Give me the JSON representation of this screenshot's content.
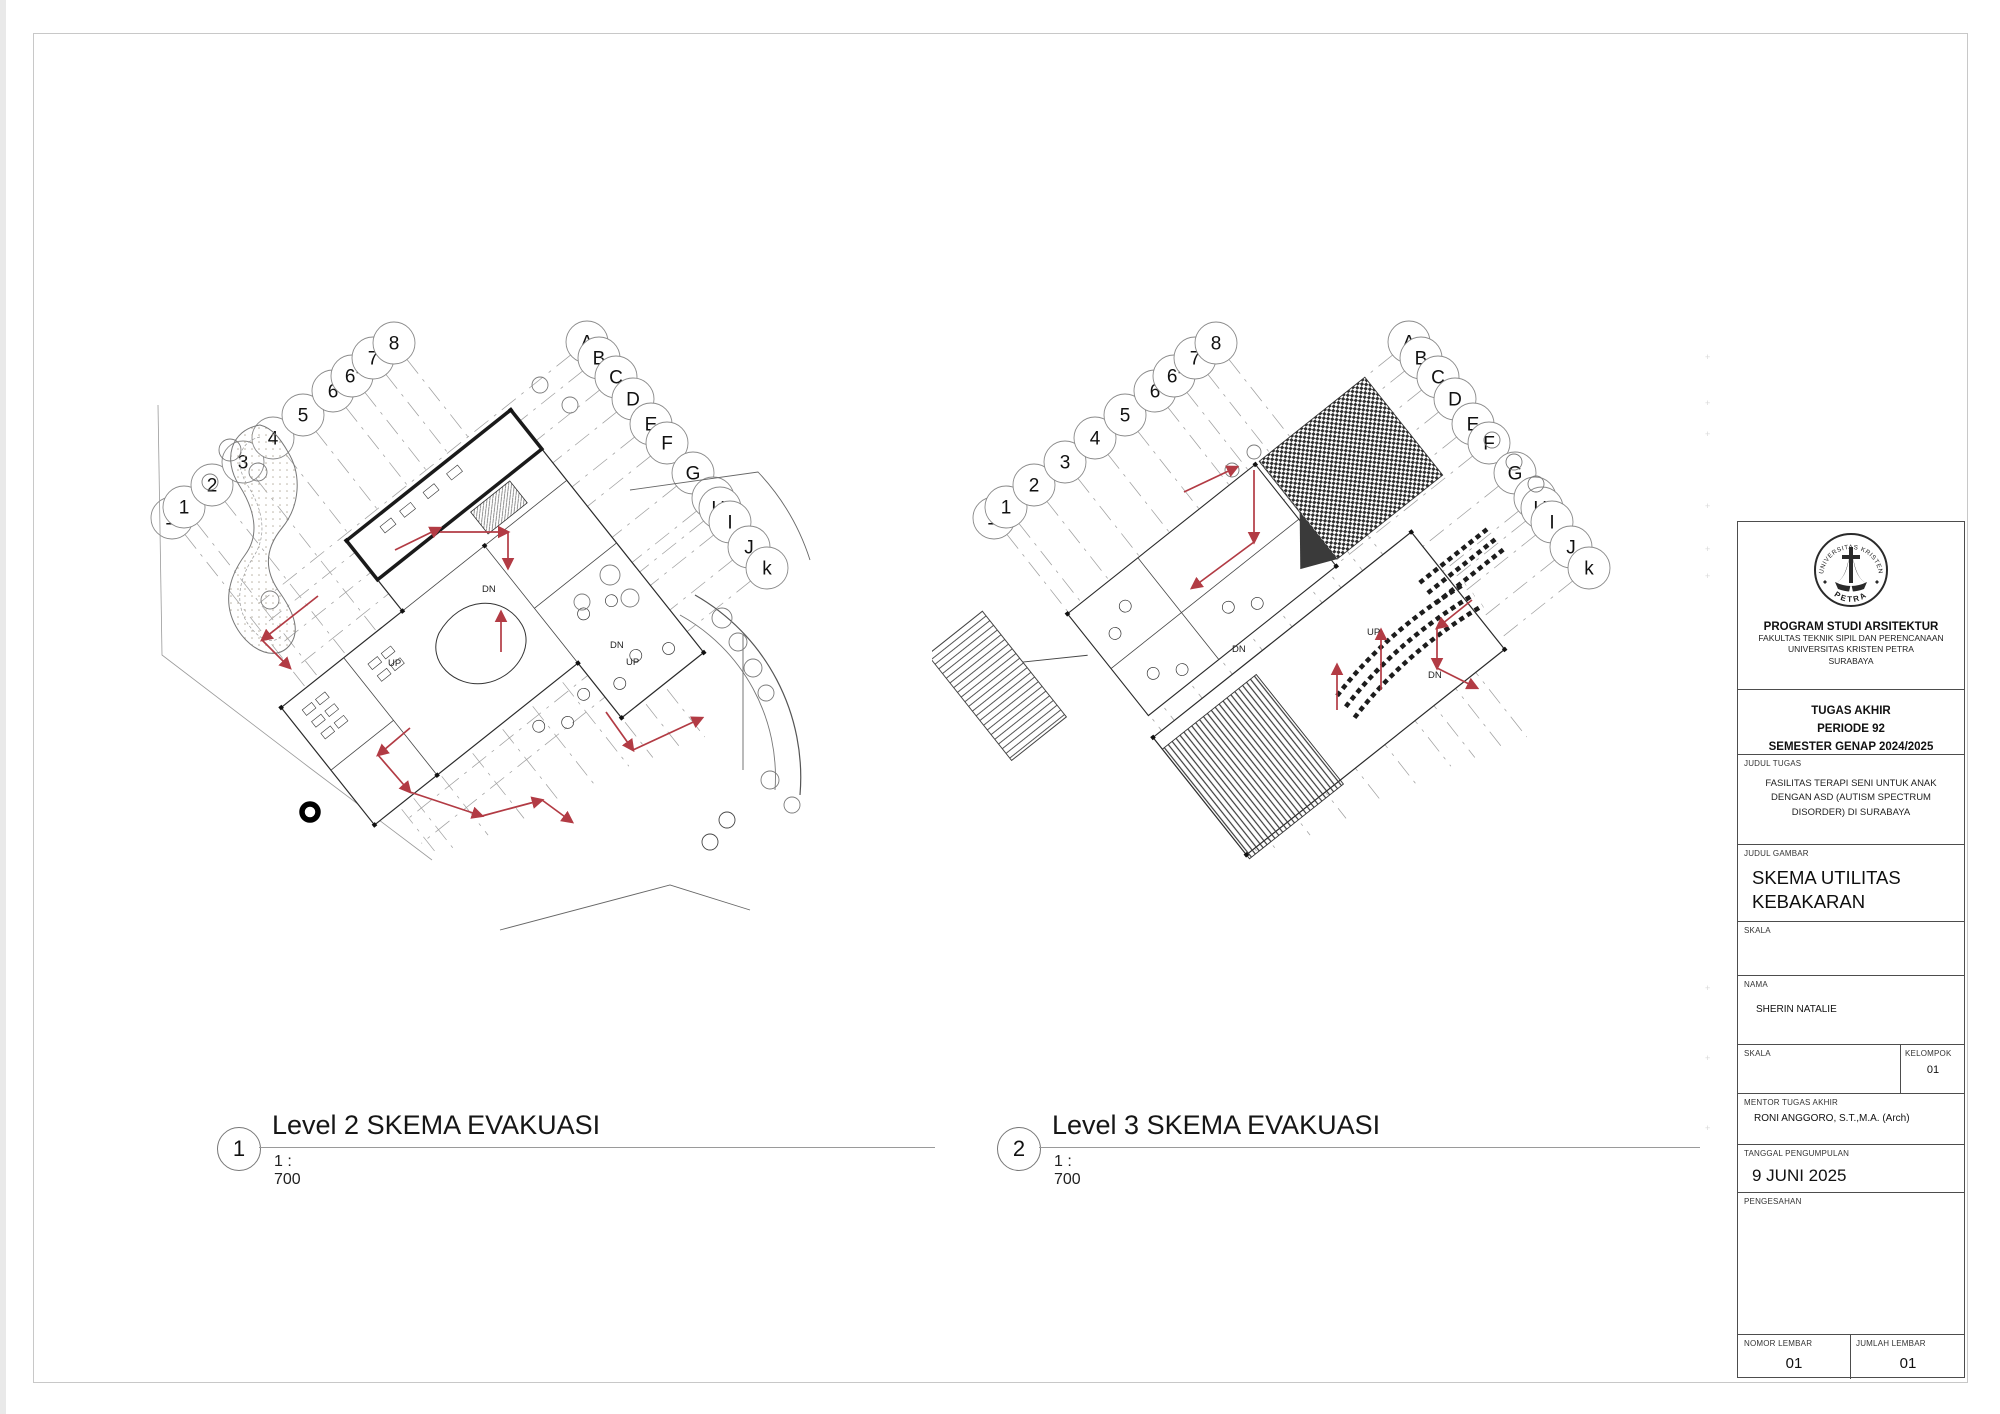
{
  "sheet": {
    "plan1": {
      "number": "1",
      "title": "Level 2 SKEMA EVAKUASI",
      "scale": "1 : 700"
    },
    "plan2": {
      "number": "2",
      "title": "Level 3 SKEMA EVAKUASI",
      "scale": "1 : 700"
    },
    "grid_numbers": [
      "1'",
      "1",
      "2",
      "3",
      "4",
      "5",
      "6",
      "6'",
      "7",
      "8"
    ],
    "grid_letters": [
      "A",
      "B",
      "C",
      "D",
      "E",
      "F",
      "G",
      "H",
      "H'",
      "I",
      "J",
      "k"
    ],
    "plan_labels": {
      "dn": "DN",
      "up": "UP"
    }
  },
  "titleblock": {
    "logo": {
      "arc_top": "UNIVERSITAS KRISTEN",
      "arc_bottom": "PETRA"
    },
    "program": {
      "line1": "PROGRAM STUDI ARSITEKTUR",
      "line2": "FAKULTAS TEKNIK SIPIL DAN PERENCANAAN",
      "line3": "UNIVERSITAS KRISTEN PETRA",
      "line4": "SURABAYA"
    },
    "tugas": {
      "line1": "TUGAS AKHIR",
      "line2": "PERIODE 92",
      "line3": "SEMESTER GENAP 2024/2025"
    },
    "judul_tugas": {
      "label": "JUDUL TUGAS",
      "value": "FASILITAS TERAPI SENI UNTUK ANAK DENGAN ASD (AUTISM SPECTRUM DISORDER) DI SURABAYA"
    },
    "judul_gambar": {
      "label": "JUDUL GAMBAR",
      "value": "SKEMA UTILITAS KEBAKARAN"
    },
    "skala1": {
      "label": "SKALA",
      "value": ""
    },
    "nama": {
      "label": "NAMA",
      "value": "SHERIN NATALIE"
    },
    "skala2": {
      "label": "SKALA",
      "value": ""
    },
    "kelompok": {
      "label": "KELOMPOK",
      "value": "01"
    },
    "mentor": {
      "label": "MENTOR TUGAS AKHIR",
      "value": "RONI ANGGORO, S.T.,M.A. (Arch)"
    },
    "tanggal": {
      "label": "TANGGAL PENGUMPULAN",
      "value": "9 JUNI 2025"
    },
    "pengesahan": {
      "label": "PENGESAHAN"
    },
    "nomor": {
      "label": "NOMOR LEMBAR",
      "value": "01"
    },
    "jumlah": {
      "label": "JUMLAH LEMBAR",
      "value": "01"
    }
  },
  "colors": {
    "evacuation_red": "#b23b44",
    "grid_gray": "#a0a0a0",
    "line_dark": "#2a2a2a"
  }
}
